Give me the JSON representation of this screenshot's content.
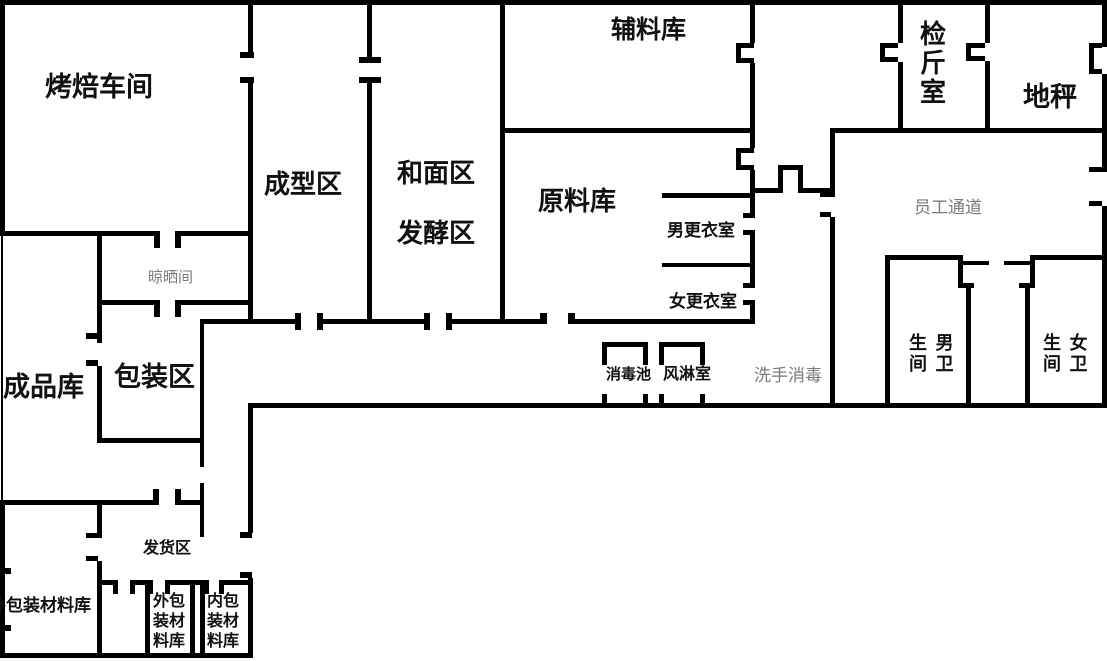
{
  "title": "bakery-floor-plan",
  "colors": {
    "wall": "#000000",
    "label": "#111111",
    "muted_label": "#7a7a7a",
    "background": "#ffffff"
  },
  "rooms": {
    "baking_workshop": {
      "label": "烤焙车间"
    },
    "forming_area": {
      "label": "成型区"
    },
    "dough_mixing_area": {
      "label": "和面区"
    },
    "fermentation_area": {
      "label": "发酵区"
    },
    "auxiliary_material_store": {
      "label": "辅料库"
    },
    "raw_material_store": {
      "label": "原料库"
    },
    "weighing_room": {
      "label": "检斤室"
    },
    "floor_scale": {
      "label": "地秤"
    },
    "drying_room": {
      "label": "晾晒间"
    },
    "mens_changing_room": {
      "label": "男更衣室"
    },
    "womens_changing_room": {
      "label": "女更衣室"
    },
    "staff_corridor": {
      "label": "员工通道"
    },
    "finished_goods_store": {
      "label": "成品库"
    },
    "packaging_area": {
      "label": "包装区"
    },
    "disinfection_pool": {
      "label": "消毒池"
    },
    "air_shower": {
      "label": "风淋室"
    },
    "hand_wash_disinfection": {
      "label": "洗手消毒"
    },
    "mens_toilet": {
      "label": "男卫生间",
      "line1": "生 男",
      "line2": "间 卫"
    },
    "womens_toilet": {
      "label": "女卫生间",
      "line1": "生 女",
      "line2": "间 卫"
    },
    "shipping_area": {
      "label": "发货区"
    },
    "outer_packaging_material_store": {
      "label": "外包装材料库"
    },
    "outer_packaging_material_store_small": {
      "label": "外包装材料库"
    },
    "inner_packaging_material_store": {
      "label": "内包装材料库"
    }
  }
}
